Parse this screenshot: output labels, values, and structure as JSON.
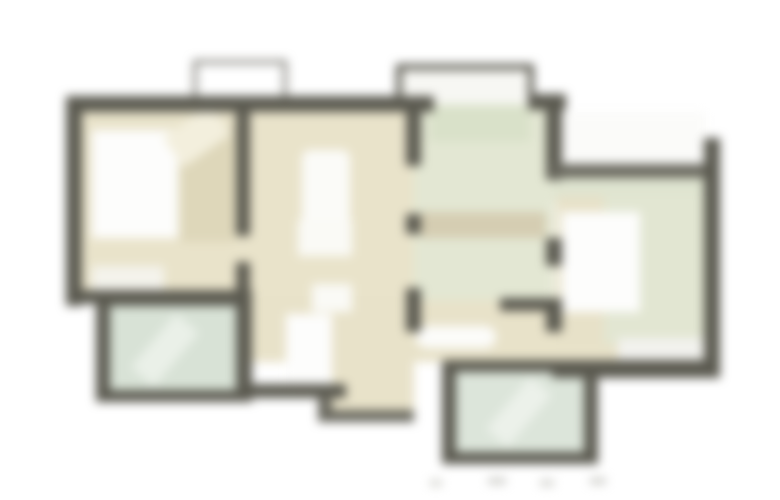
{
  "meta": {
    "type": "apartment-floor-plan",
    "canvas": {
      "w": 780,
      "h": 500
    },
    "background": "#ffffff",
    "blur_px": 5
  },
  "palette": {
    "wall_dark": "#5b5a50",
    "wall_medium": "#6a695f",
    "wall_light_outline": "#82817a",
    "floor_beige": "#e9e3ca",
    "floor_beige_dark": "#d5cdb2",
    "hall_green": "#e3e7d3",
    "walkway_green": "#dfe4d0",
    "tile_green_bath": "#d8e2d6",
    "tile_green_balcony": "#dce5da",
    "furniture_white": "#fdfdfc",
    "wood_beige": "#ded7ba",
    "dash_gray": "#c9c9c4"
  },
  "shapes": [
    {
      "name": "balcony-outline-top-left",
      "x": 193,
      "y": 60,
      "w": 94,
      "h": 46,
      "fill": "#ffffff",
      "border": "4px solid #82817a"
    },
    {
      "name": "balcony-outline-top-center",
      "x": 396,
      "y": 64,
      "w": 138,
      "h": 48,
      "fill": "#f7f7f3",
      "border": "6px solid #5b5a50"
    },
    {
      "name": "left-wing-floor",
      "x": 74,
      "y": 104,
      "w": 340,
      "h": 200,
      "fill": "#e9e3ca"
    },
    {
      "name": "corridor-floor",
      "x": 240,
      "y": 296,
      "w": 390,
      "h": 66,
      "fill": "#e8e2c9"
    },
    {
      "name": "corridor-step",
      "x": 322,
      "y": 356,
      "w": 92,
      "h": 62,
      "fill": "#e8e2c9"
    },
    {
      "name": "entry-hall-floor",
      "x": 414,
      "y": 104,
      "w": 140,
      "h": 196,
      "fill": "#e3e7d3"
    },
    {
      "name": "entry-door-mat",
      "x": 430,
      "y": 106,
      "w": 100,
      "h": 36,
      "fill": "#d9e1c9"
    },
    {
      "name": "hall-cabinet-band",
      "x": 420,
      "y": 212,
      "w": 126,
      "h": 26,
      "fill": "#d5cdb2"
    },
    {
      "name": "right-terrace-white",
      "x": 560,
      "y": 112,
      "w": 146,
      "h": 58,
      "fill": "#fbfbf9"
    },
    {
      "name": "right-walkway",
      "x": 554,
      "y": 170,
      "w": 154,
      "h": 32,
      "fill": "#dfe4d0"
    },
    {
      "name": "right-bedroom-floor",
      "x": 556,
      "y": 196,
      "w": 152,
      "h": 148,
      "fill": "#e2e6d2"
    },
    {
      "name": "right-bedroom-strip",
      "x": 556,
      "y": 196,
      "w": 48,
      "h": 148,
      "fill": "#e7e1c8"
    },
    {
      "name": "right-bed",
      "x": 562,
      "y": 212,
      "w": 78,
      "h": 100,
      "fill": "#fdfdfc"
    },
    {
      "name": "right-window-sill",
      "x": 618,
      "y": 338,
      "w": 88,
      "h": 24,
      "fill": "#f2f2ee"
    },
    {
      "name": "left-bed",
      "x": 92,
      "y": 130,
      "w": 86,
      "h": 108,
      "fill": "#fdfdfc"
    },
    {
      "name": "left-wardrobe",
      "x": 180,
      "y": 126,
      "w": 54,
      "h": 116,
      "fill": "#ded7ba"
    },
    {
      "name": "left-closet-diagonal",
      "x": 168,
      "y": 118,
      "w": 58,
      "h": 36,
      "fill": "#f3efdd",
      "rotate": -35
    },
    {
      "name": "left-dresser",
      "x": 92,
      "y": 266,
      "w": 72,
      "h": 26,
      "fill": "#f4f3ec"
    },
    {
      "name": "living-table",
      "x": 302,
      "y": 150,
      "w": 48,
      "h": 100,
      "fill": "#fbfbf8",
      "radius": 8
    },
    {
      "name": "living-sofa",
      "x": 298,
      "y": 220,
      "w": 54,
      "h": 36,
      "fill": "#fafaf6"
    },
    {
      "name": "living-chair",
      "x": 312,
      "y": 284,
      "w": 40,
      "h": 28,
      "fill": "#fafaf6"
    },
    {
      "name": "corridor-table-pill",
      "x": 416,
      "y": 326,
      "w": 80,
      "h": 22,
      "fill": "#fcfcfa",
      "radius": 11
    },
    {
      "name": "wc-room",
      "x": 286,
      "y": 314,
      "w": 46,
      "h": 72,
      "fill": "#fdfdfc"
    },
    {
      "name": "bathroom-walls",
      "x": 96,
      "y": 294,
      "w": 156,
      "h": 108,
      "fill": "#5b5a50"
    },
    {
      "name": "bathroom-tiles",
      "x": 110,
      "y": 306,
      "w": 128,
      "h": 84,
      "fill": "#d8e2d6"
    },
    {
      "name": "bathroom-highlight",
      "x": 150,
      "y": 315,
      "w": 30,
      "h": 70,
      "fill": "#eaf0e8",
      "rotate": 40
    },
    {
      "name": "balcony-walls",
      "x": 442,
      "y": 360,
      "w": 156,
      "h": 104,
      "fill": "#5b5a50"
    },
    {
      "name": "balcony-tiles",
      "x": 456,
      "y": 372,
      "w": 128,
      "h": 80,
      "fill": "#dce5da"
    },
    {
      "name": "balcony-highlight",
      "x": 505,
      "y": 378,
      "w": 28,
      "h": 68,
      "fill": "#ecf1ea",
      "rotate": 40
    },
    {
      "name": "wall-top-main",
      "x": 66,
      "y": 96,
      "w": 368,
      "h": 16,
      "fill": "#5b5a50"
    },
    {
      "name": "wall-top-right-stub",
      "x": 528,
      "y": 94,
      "w": 38,
      "h": 16,
      "fill": "#5b5a50"
    },
    {
      "name": "wall-left",
      "x": 66,
      "y": 96,
      "w": 16,
      "h": 210,
      "fill": "#5b5a50"
    },
    {
      "name": "wall-left-wing-bottom",
      "x": 66,
      "y": 290,
      "w": 186,
      "h": 14,
      "fill": "#5b5a50"
    },
    {
      "name": "wall-bedroom-divider-top",
      "x": 236,
      "y": 108,
      "w": 14,
      "h": 128,
      "fill": "#5b5a50"
    },
    {
      "name": "wall-bedroom-divider-bottom",
      "x": 236,
      "y": 262,
      "w": 14,
      "h": 44,
      "fill": "#5b5a50"
    },
    {
      "name": "wall-bathroom-right",
      "x": 236,
      "y": 292,
      "w": 14,
      "h": 108,
      "fill": "#5b5a50"
    },
    {
      "name": "wall-wc-bottom",
      "x": 246,
      "y": 384,
      "w": 100,
      "h": 14,
      "fill": "#5b5a50"
    },
    {
      "name": "wall-step-left",
      "x": 318,
      "y": 396,
      "w": 14,
      "h": 26,
      "fill": "#6a695f"
    },
    {
      "name": "wall-step-bottom",
      "x": 318,
      "y": 410,
      "w": 96,
      "h": 12,
      "fill": "#6a695f"
    },
    {
      "name": "wall-hall-left-1",
      "x": 406,
      "y": 108,
      "w": 15,
      "h": 58,
      "fill": "#5b5a50"
    },
    {
      "name": "wall-hall-left-2",
      "x": 406,
      "y": 214,
      "w": 15,
      "h": 20,
      "fill": "#5b5a50"
    },
    {
      "name": "wall-hall-left-3",
      "x": 406,
      "y": 288,
      "w": 15,
      "h": 44,
      "fill": "#5b5a50"
    },
    {
      "name": "wall-hall-right-1",
      "x": 546,
      "y": 94,
      "w": 16,
      "h": 86,
      "fill": "#5b5a50"
    },
    {
      "name": "wall-hall-right-2",
      "x": 546,
      "y": 238,
      "w": 16,
      "h": 28,
      "fill": "#5b5a50"
    },
    {
      "name": "wall-hall-right-3",
      "x": 546,
      "y": 298,
      "w": 16,
      "h": 34,
      "fill": "#5b5a50"
    },
    {
      "name": "wall-hall-bottom-stub",
      "x": 500,
      "y": 298,
      "w": 48,
      "h": 13,
      "fill": "#5b5a50"
    },
    {
      "name": "wall-right-wing-top",
      "x": 552,
      "y": 164,
      "w": 156,
      "h": 14,
      "fill": "#6a695f"
    },
    {
      "name": "wall-right",
      "x": 704,
      "y": 138,
      "w": 16,
      "h": 240,
      "fill": "#5b5a50"
    },
    {
      "name": "wall-right-wing-bottom",
      "x": 552,
      "y": 360,
      "w": 168,
      "h": 18,
      "fill": "#5b5a50"
    },
    {
      "name": "dimension-dash-1",
      "x": 430,
      "y": 480,
      "w": 12,
      "h": 6,
      "fill": "#d2d2cc"
    },
    {
      "name": "dimension-dash-2",
      "x": 488,
      "y": 478,
      "w": 18,
      "h": 6,
      "fill": "#c9c9c4"
    },
    {
      "name": "dimension-dash-3",
      "x": 540,
      "y": 480,
      "w": 14,
      "h": 6,
      "fill": "#cfcfca"
    },
    {
      "name": "dimension-dash-4",
      "x": 590,
      "y": 478,
      "w": 16,
      "h": 6,
      "fill": "#c9c9c4"
    }
  ]
}
